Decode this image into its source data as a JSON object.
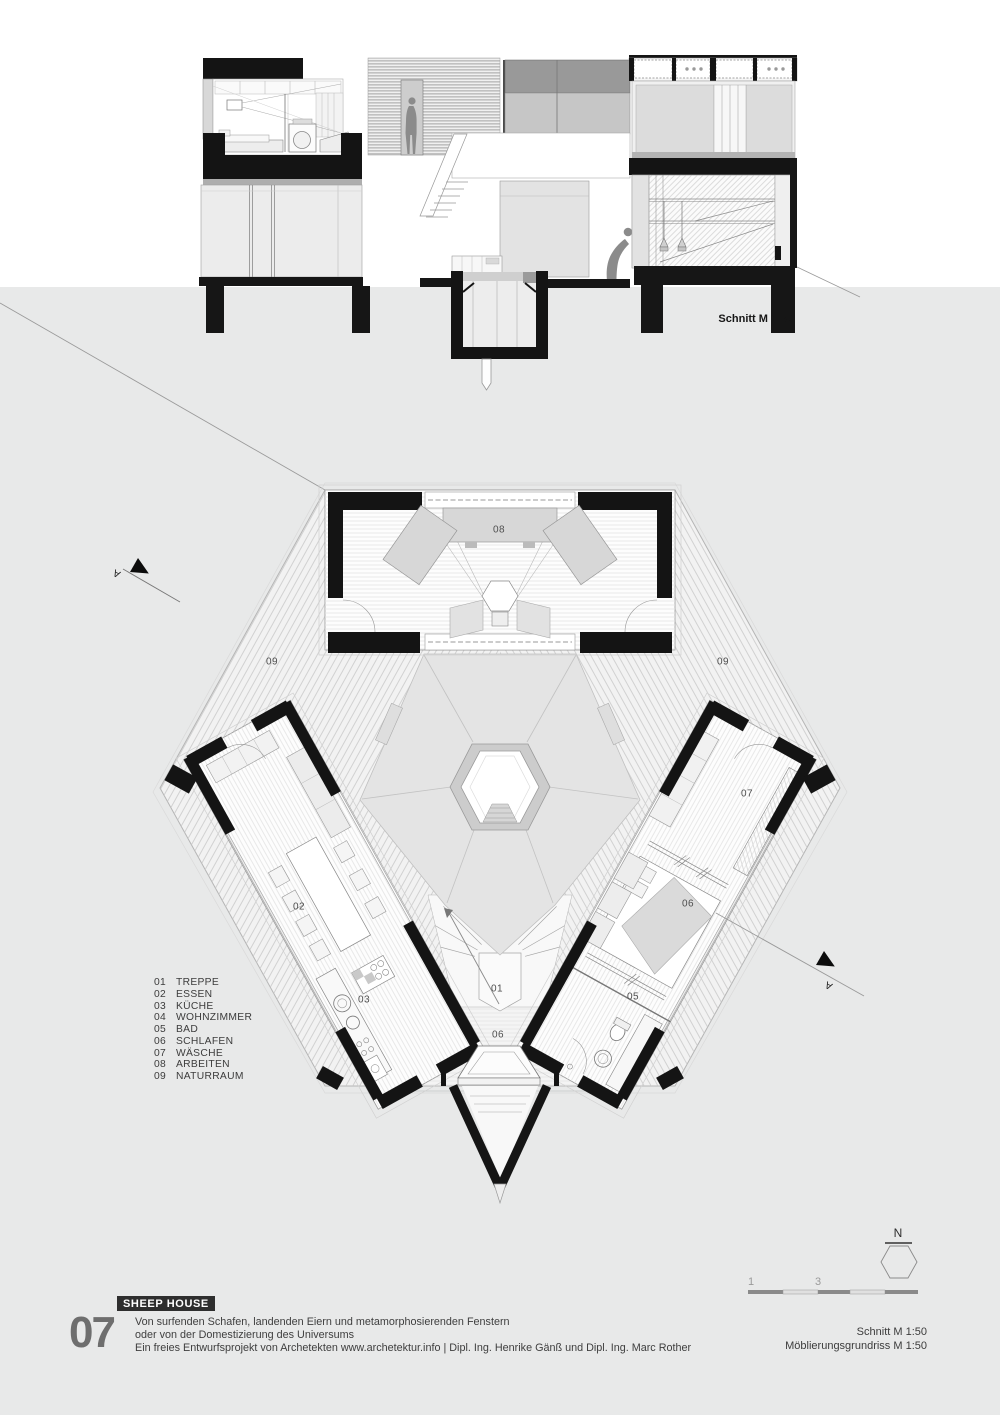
{
  "section": {
    "label": "Schnitt M 1:50"
  },
  "section_markers": {
    "letter": "A"
  },
  "plan": {
    "labels": {
      "stairs": "01",
      "dining": "02",
      "kitchen": "03",
      "bath": "05",
      "sleep_wing": "06",
      "sleep_deck": "06",
      "laundry": "07",
      "work": "08",
      "nature_left": "09",
      "nature_right": "09"
    }
  },
  "legend": {
    "items": [
      {
        "num": "01",
        "name": "TREPPE"
      },
      {
        "num": "02",
        "name": "ESSEN"
      },
      {
        "num": "03",
        "name": "KÜCHE"
      },
      {
        "num": "04",
        "name": "WOHNZIMMER"
      },
      {
        "num": "05",
        "name": "BAD"
      },
      {
        "num": "06",
        "name": "SCHLAFEN"
      },
      {
        "num": "07",
        "name": "WÄSCHE"
      },
      {
        "num": "08",
        "name": "ARBEITEN"
      },
      {
        "num": "09",
        "name": "NATURRAUM"
      }
    ]
  },
  "compass": {
    "north": "N"
  },
  "scalebar": {
    "tick1": "1",
    "tick2": "3"
  },
  "footer": {
    "project_tag": "SHEEP HOUSE",
    "sheet_number": "07",
    "description_line1": "Von surfenden Schafen, landenden Eiern und metamorphosierenden Fenstern",
    "description_line2": "oder von der Domestizierung des Universums",
    "description_line3": "Ein freies Entwurfsprojekt von Archetekten www.archetektur.info | Dipl. Ing. Henrike Gänß und Dipl. Ing. Marc Rother",
    "scale_line1": "Schnitt M 1:50",
    "scale_line2": "Möblierungsgrundriss M 1:50"
  },
  "colors": {
    "ink": "#141414",
    "paper": "#ffffff",
    "ground": "#e8e9e9",
    "title_bar": "#2e2e2e",
    "silhouette": "#8b8b8b"
  }
}
